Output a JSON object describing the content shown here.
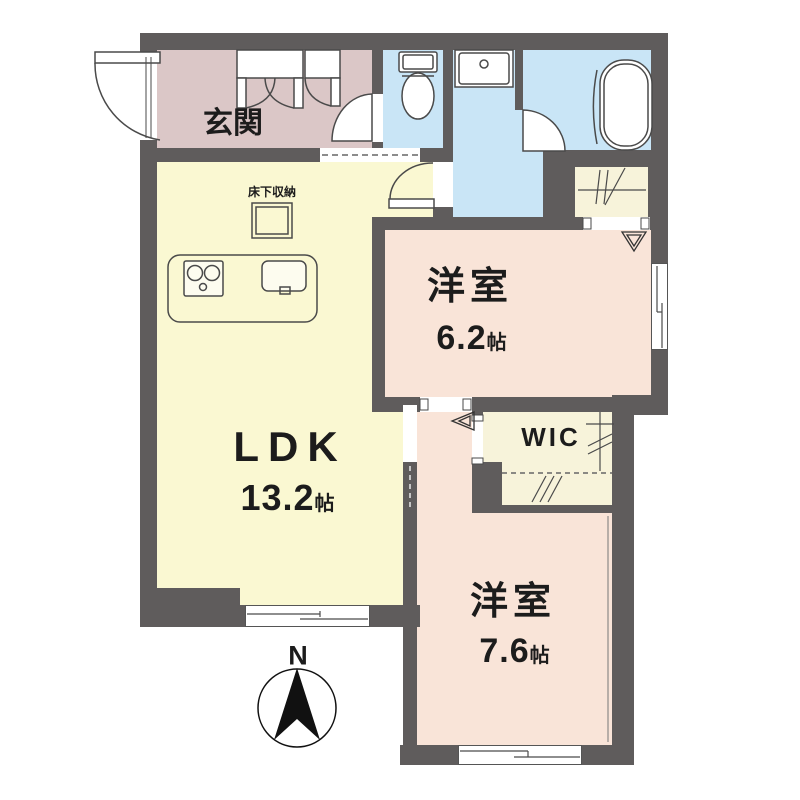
{
  "plan_title": "1LDK+WIC floor plan",
  "rooms": {
    "genkan": {
      "label": "玄関"
    },
    "ldk": {
      "label": "LDK",
      "size": "13.2",
      "unit": "帖"
    },
    "bedroom1": {
      "label": "洋室",
      "size": "6.2",
      "unit": "帖"
    },
    "bedroom2": {
      "label": "洋室",
      "size": "7.6",
      "unit": "帖"
    },
    "wic": {
      "label": "WIC"
    },
    "underfloor": {
      "label": "床下収納"
    }
  },
  "compass": {
    "label": "N"
  },
  "colors": {
    "wall": "#5f5c5c",
    "genkan": "#dbc7c7",
    "ldk": "#faf8d2",
    "bedroom": "#f9e4d8",
    "closet": "#f7f3da",
    "water": "#c9e5f6",
    "line": "#4a4a4a"
  }
}
